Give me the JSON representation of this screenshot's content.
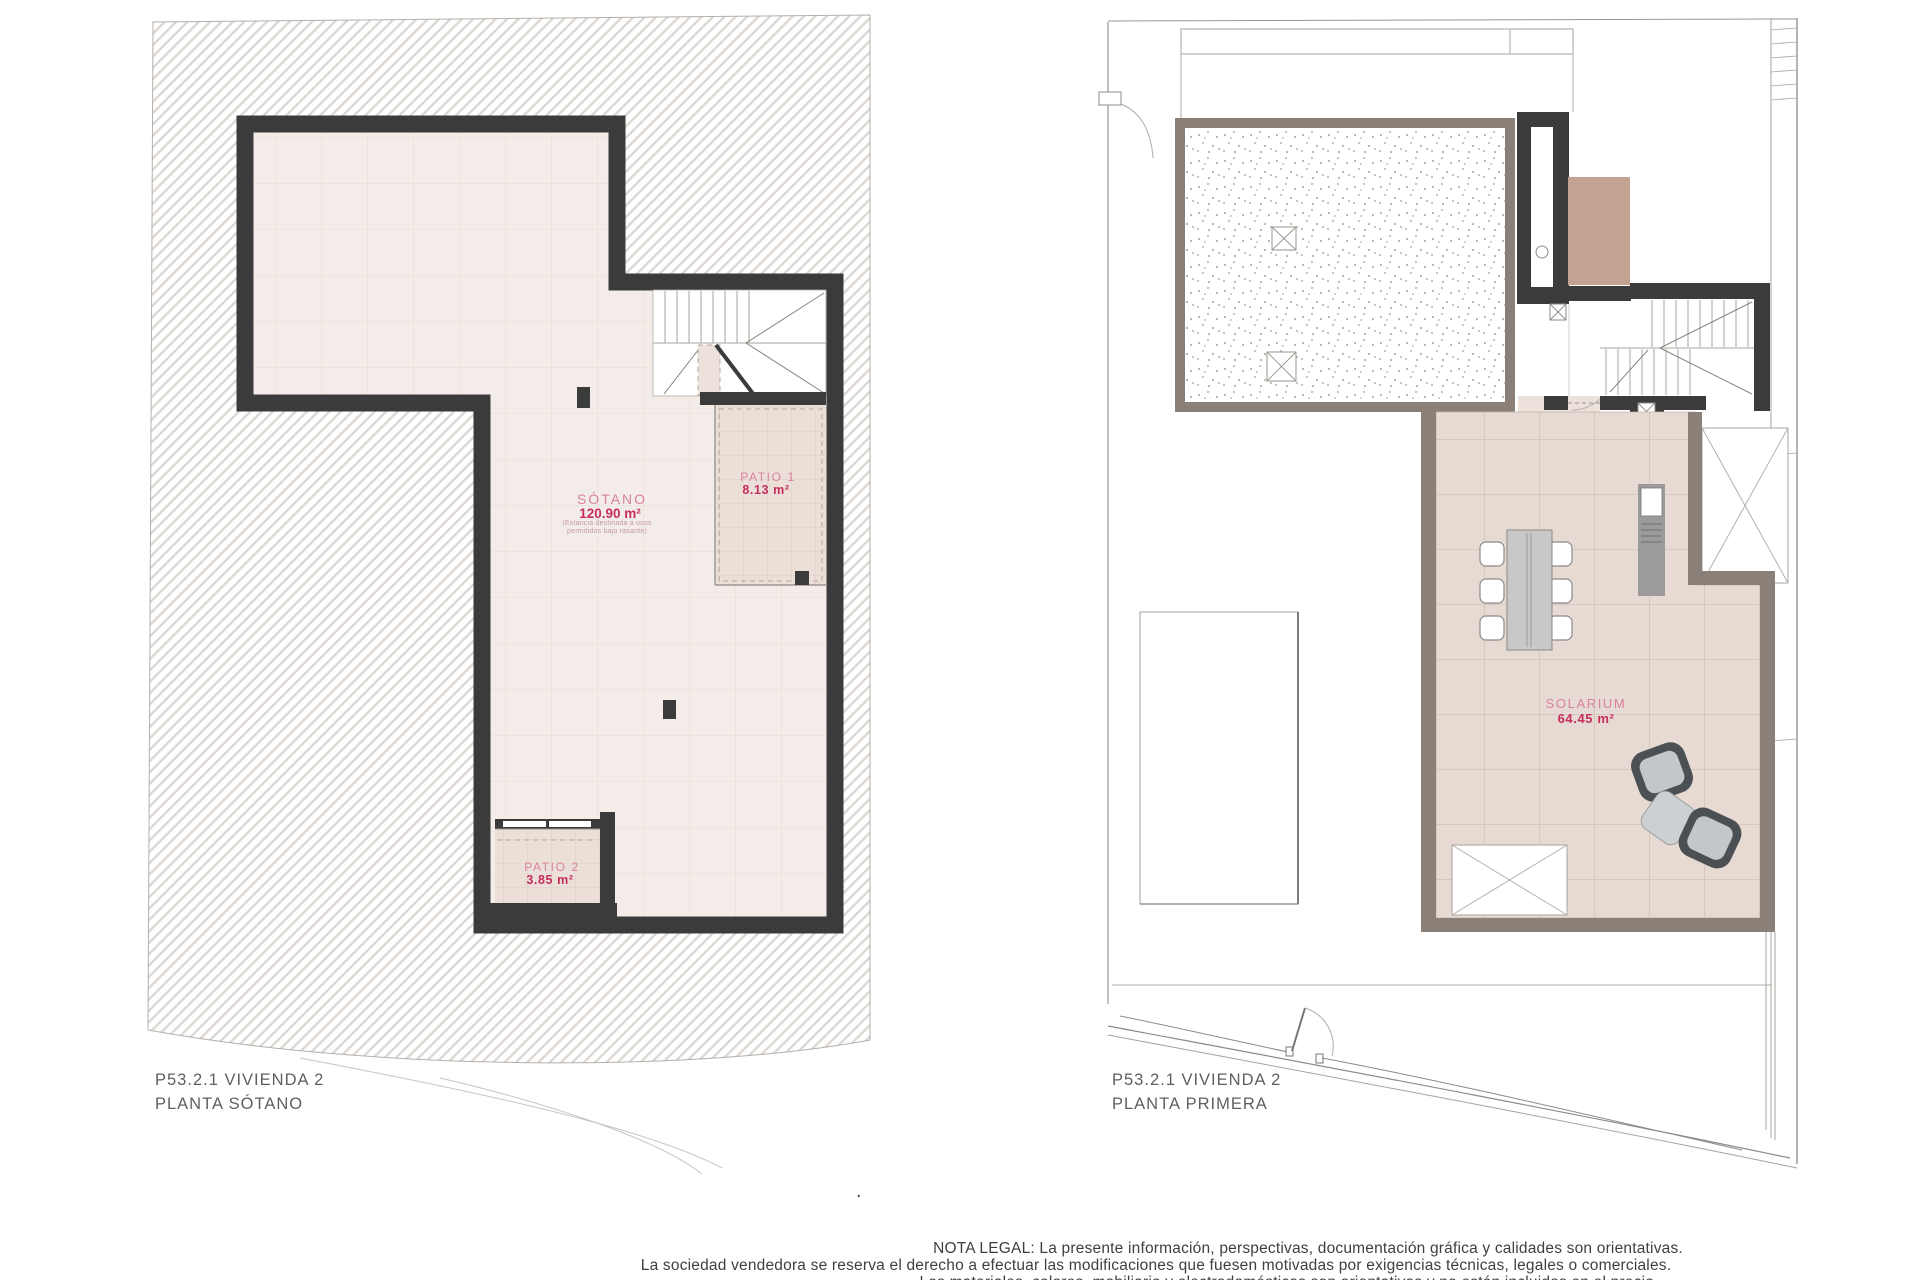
{
  "left_plan": {
    "title_line1": "P53.2.1 VIVIENDA 2",
    "title_line2": "PLANTA SÓTANO",
    "rooms": {
      "sotano": {
        "name": "SÓTANO",
        "area": "120.90 m²",
        "note_line1": "(Estancia destinada a usos",
        "note_line2": "permitidos bajo rasante)"
      },
      "patio1": {
        "name": "PATIO 1",
        "area": "8.13 m²"
      },
      "patio2": {
        "name": "PATIO 2",
        "area": "3.85 m²"
      }
    }
  },
  "right_plan": {
    "title_line1": "P53.2.1 VIVIENDA 2",
    "title_line2": "PLANTA PRIMERA",
    "rooms": {
      "solarium": {
        "name": "SOLARIUM",
        "area": "64.45 m²"
      }
    }
  },
  "legal": {
    "line1": "NOTA LEGAL: La presente información, perspectivas, documentación gráfica y calidades son orientativas.",
    "line2": "La sociedad vendedora se reserva el derecho a efectuar las modificaciones que fuesen motivadas por exigencias técnicas, legales o comerciales.",
    "line3": "Los materiales, colores, mobiliario y electrodomésticos son orientativos y no están incluidos en el precio.",
    "separator_dot": "."
  },
  "colors": {
    "wall_dark": "#3b3b3b",
    "wall_taupe": "#8b8078",
    "floor_beige": "#f3ece8",
    "solarium_floor": "#e6dad3",
    "label_rose": "#d9839b",
    "label_crimson": "#c62e5c",
    "tan_block": "#c2a392"
  }
}
